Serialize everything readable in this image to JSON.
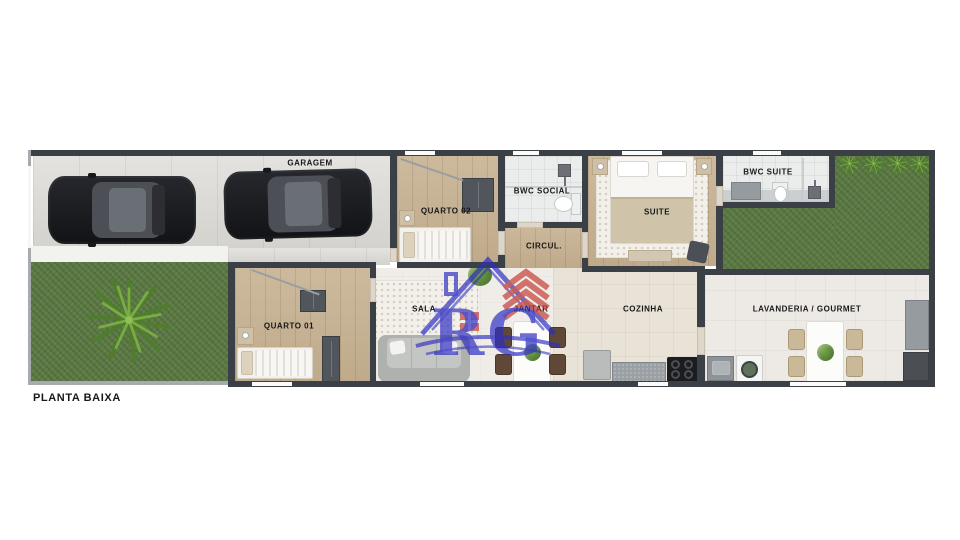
{
  "page": {
    "title_label": "PLANTA BAIXA"
  },
  "watermark": {
    "logo_text": "RG"
  },
  "rooms": {
    "garagem": {
      "label": "GARAGEM"
    },
    "quarto_02": {
      "label": "QUARTO 02"
    },
    "bwc_social": {
      "label": "BWC SOCIAL"
    },
    "circul": {
      "label": "CIRCUL."
    },
    "suite": {
      "label": "SUITE"
    },
    "bwc_suite": {
      "label": "BWC SUITE"
    },
    "quarto_01": {
      "label": "QUARTO 01"
    },
    "sala": {
      "label": "SALA"
    },
    "jantar": {
      "label": "JANTAR"
    },
    "cozinha": {
      "label": "COZINHA"
    },
    "lavanderia_gourmet": {
      "label": "LAVANDERIA / GOURMET"
    }
  },
  "colors": {
    "wall": "#3b4046",
    "wall_light": "#565a60",
    "grass": "#5c7a44",
    "wood": "#c7b191",
    "label_text": "#17181a",
    "logo_blue": "#2e2ec2",
    "logo_red": "#c23f38"
  }
}
